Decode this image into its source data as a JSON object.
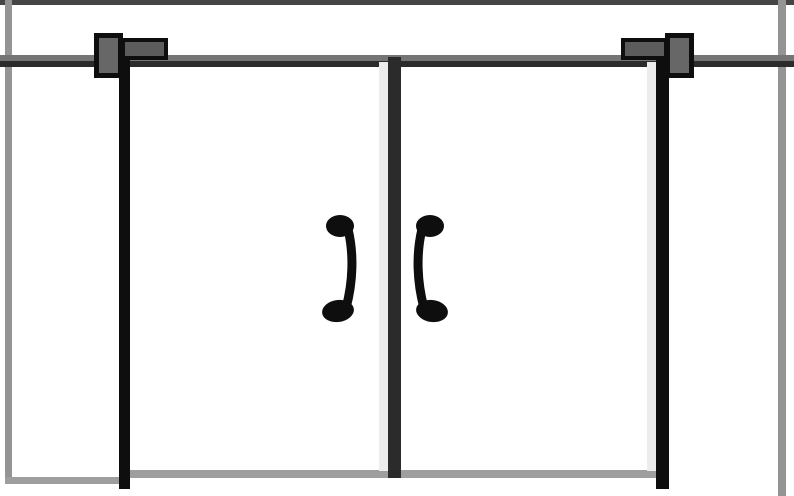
{
  "page": {
    "title": "Double swing doors - front elevation drawing"
  },
  "colors": {
    "background": "#ffffff",
    "ink": "#0e0e0e",
    "dark_gray": "#2b2b2b",
    "header_gray": "#757575",
    "wall_gray": "#949494",
    "top_wall_gray": "#454545",
    "closer_fill": "#676767",
    "closer_arm_fill": "#5c5c5c",
    "edge_highlight": "#ececec",
    "threshold_gray": "#9e9e9e"
  },
  "parts": {
    "scene": "Front elevation of a pair of closed double doors",
    "top_wall": "Top wall line",
    "left_wall": "Left wall line",
    "right_wall": "Right wall line",
    "left_wall_floor": "Left wall floor line",
    "header": "Door head / lintel line",
    "left_door": "Left door leaf",
    "right_door": "Right door leaf",
    "left_hinge_stile": "Left door hinge stile",
    "center_stile": "Center meeting stile",
    "right_hinge_stile": "Right door hinge stile",
    "left_closer": "Overhead door closer on left door",
    "right_closer": "Overhead door closer on right door",
    "left_handle": "Pull handle on left door",
    "right_handle": "Pull handle on right door",
    "threshold": "Door threshold line"
  }
}
